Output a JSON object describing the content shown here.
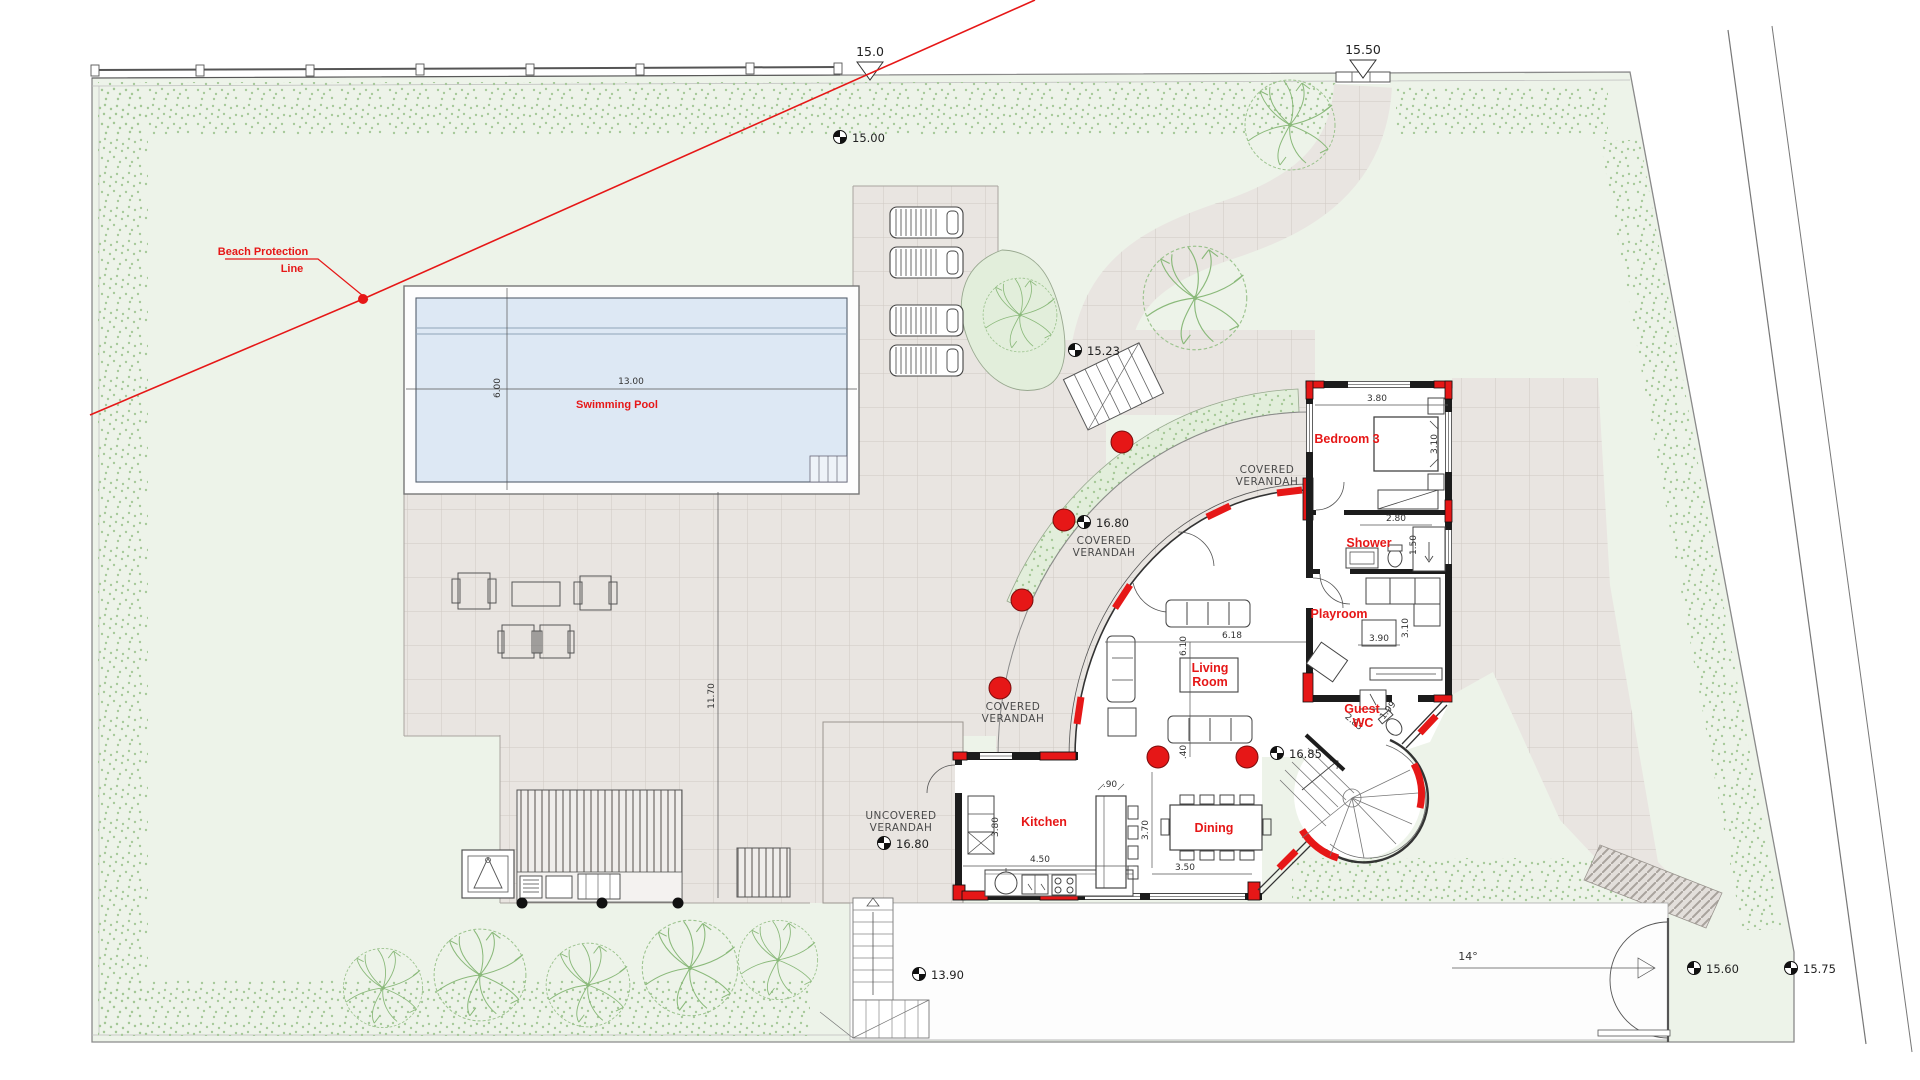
{
  "plan": {
    "labels": {
      "beach1": "Beach Protection",
      "beach2": "Line",
      "pool": "Swimming Pool",
      "covered1": "COVERED",
      "covered2": "VERANDAH",
      "uncovered1": "UNCOVERED",
      "uncovered2": "VERANDAH",
      "bedroom3": "Bedroom 3",
      "shower": "Shower",
      "playroom": "Playroom",
      "living1": "Living",
      "living2": "Room",
      "guest1": "Guest",
      "guest2": "WC",
      "kitchen": "Kitchen",
      "dining": "Dining"
    },
    "markers": {
      "plot_top": "15.0",
      "entrance_top": "15.50",
      "garden_nw": "15.00",
      "pool_terrace": "15.23",
      "covered_verandah": "16.80",
      "uncovered_verandah": "16.80",
      "living_room": "16.85",
      "lower_terrace": "13.90",
      "driveway_gate": "15.60",
      "road": "15.75"
    },
    "dimensions": {
      "pool_length": "13.00",
      "pool_width": "6.00",
      "terrace_side": "11.70",
      "bedroom_width": "3.80",
      "bedroom_depth": "3.10",
      "shower_width": "2.80",
      "shower_depth": "1.50",
      "playroom_width": "3.90",
      "playroom_depth": "3.10",
      "living_width": "6.18",
      "living_depth": "6.10",
      "living_offset": ".40",
      "kitchen_width": "4.50",
      "kitchen_depth": "3.80",
      "island_depth": ".90",
      "dining_depth": "3.70",
      "dining_width": "3.50",
      "guest_wc_a": "2.83",
      "guest_wc_b": "1.99",
      "driveway_angle": "14°"
    },
    "colors": {
      "accent_red": "#e61717",
      "water": "#dde8f4",
      "garden": "#edf3e9",
      "paving": "#e9e5e1",
      "foliage": "#9cc38e"
    }
  }
}
